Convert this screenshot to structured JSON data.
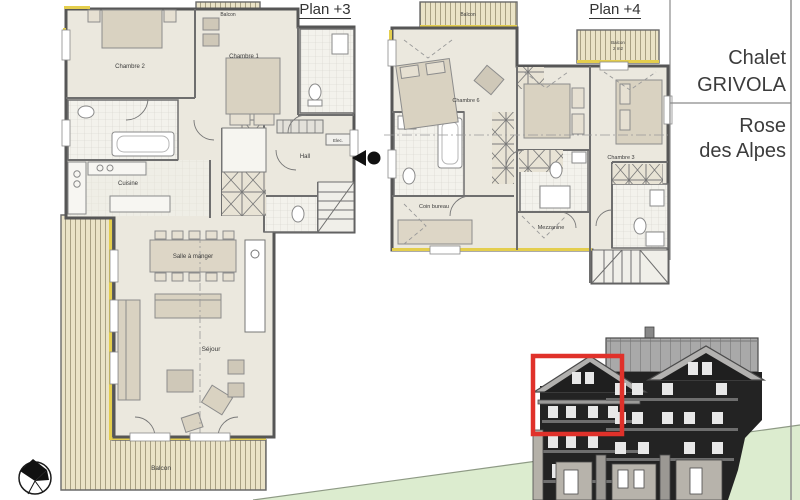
{
  "document": {
    "type": "architectural floor plan sheet",
    "sheet_titles": [
      "Plan +3",
      "Plan +4"
    ]
  },
  "plans": {
    "plan3": {
      "title": "Plan +3",
      "rooms": {
        "balcon_top": "Balcon",
        "chambre2": "Chambre 2",
        "chambre1": "Chambre 1",
        "cuisine": "Cuisine",
        "hall": "Hall",
        "elec": "Elec.",
        "salle_a_manger": "Salle à manger",
        "sejour": "Séjour",
        "balcon": "Balcon"
      }
    },
    "plan4": {
      "title": "Plan +4",
      "rooms": {
        "balcon_top": "Balcon",
        "balcon_right_line1": "Balcon",
        "balcon_right_line2": "2 m2",
        "chambre6": "Chambre 6",
        "chambre3": "Chambre 3",
        "coin_bureau": "Coin bureau",
        "mezzanine": "Mezzanine"
      }
    }
  },
  "title_block": {
    "building_line1": "Chalet",
    "building_line2": "GRIVOLA",
    "unit_line1": "Rose",
    "unit_line2": "des Alpes"
  },
  "icons": {
    "north_arrow": "north-arrow-icon",
    "section_marker": "section-marker-icon"
  },
  "colors": {
    "highlight_box": "#e0312a",
    "insulation_yellow": "#e4ce4d",
    "balcony_wood": "#eae3c7",
    "floor_beige": "#ebe8de",
    "wall_gray": "#565656",
    "hill_green": "#dceccf",
    "facade_dark": "#232323",
    "roof_gray": "#a9a9a9"
  }
}
